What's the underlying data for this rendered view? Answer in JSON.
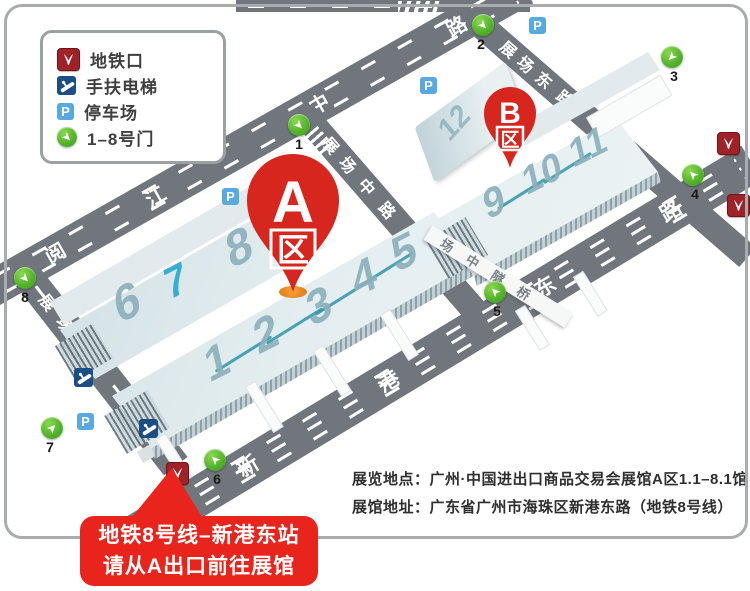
{
  "legend": {
    "items": [
      {
        "icon": "metro-icon",
        "label": "地铁口"
      },
      {
        "icon": "escalator-icon",
        "label": "手扶电梯"
      },
      {
        "icon": "parking-icon",
        "label": "停车场"
      },
      {
        "icon": "gate-icon",
        "label": "1–8号门"
      }
    ]
  },
  "roads": {
    "yuejiang": {
      "name": "阅江中路",
      "chars": [
        "阅",
        "江",
        "中",
        "路"
      ]
    },
    "zhanxi": {
      "name": "展场西路",
      "chars": [
        "展",
        "场",
        "西",
        "路"
      ]
    },
    "zhanzhong": {
      "name": "展场中路",
      "chars": [
        "展",
        "场",
        "中",
        "路"
      ]
    },
    "zhandong": {
      "name": "展场东路",
      "chars": [
        "展",
        "场",
        "东",
        "路"
      ]
    },
    "xingang": {
      "name": "新港东路",
      "chars": [
        "新",
        "港",
        "东",
        "路"
      ]
    },
    "bridge": {
      "name": "场中隧桥",
      "chars": [
        "场",
        "中",
        "隧",
        "桥"
      ]
    }
  },
  "halls": {
    "a": [
      "1",
      "2",
      "3",
      "4",
      "5",
      "6",
      "7",
      "8"
    ],
    "b": [
      "9",
      "10",
      "11",
      "12"
    ]
  },
  "pins": {
    "a": {
      "letter": "A",
      "suffix": "区"
    },
    "b": {
      "letter": "B",
      "suffix": "区"
    }
  },
  "gates": [
    "1",
    "2",
    "3",
    "4",
    "5",
    "6",
    "7",
    "8"
  ],
  "icons": {
    "parking_letter": "P"
  },
  "info": {
    "line1": "展览地点：广州·中国进出口商品交易会展馆A区1.1–8.1馆",
    "line2": "展馆地址：广东省广州市海珠区新港东路（地铁8号线）"
  },
  "callout": {
    "line1": "地铁8号线–新港东站",
    "line2": "请从A出口前往展馆"
  },
  "colors": {
    "road": "#70767b",
    "hall_number": "#8bb0bc",
    "hall7_number": "#35aed3",
    "pin_red": "#d7261e",
    "callout_red": "#e8241c",
    "metro_red": "#9e2227",
    "escalator_blue": "#1c4e86",
    "parking_blue": "#58a9e0",
    "gate_green": "#54b42c",
    "tip_orange": "#e07612"
  }
}
